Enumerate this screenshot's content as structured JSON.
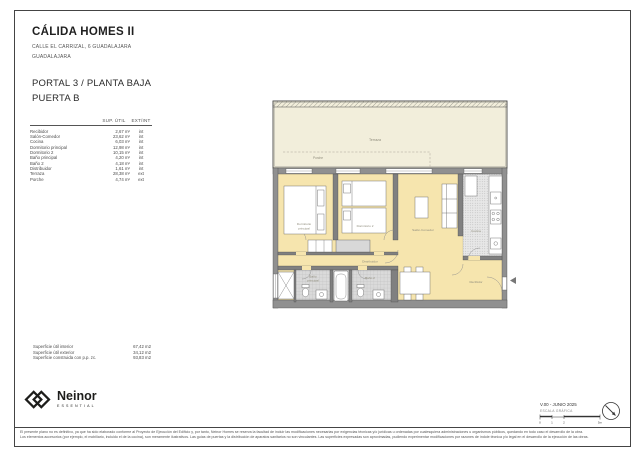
{
  "header": {
    "project": "CÁLIDA HOMES II",
    "address": "CALLE EL CARRIZAL, 6 GUADALAJARA",
    "city": "GUADALAJARA",
    "portal": "PORTAL 3 / PLANTA BAJA",
    "puerta": "PUERTA B"
  },
  "areas_table": {
    "headers": {
      "sup": "SUP. ÚTIL",
      "ext": "EXT/INT"
    },
    "rows": [
      {
        "label": "Recibidor",
        "sup": "2,67 m²",
        "ext": "int"
      },
      {
        "label": "Salón-Comedor",
        "sup": "23,62 m²",
        "ext": "int"
      },
      {
        "label": "Cocina",
        "sup": "6,03 m²",
        "ext": "int"
      },
      {
        "label": "Dormitorio principal",
        "sup": "12,98 m²",
        "ext": "int"
      },
      {
        "label": "Dormitorio 2",
        "sup": "10,15 m²",
        "ext": "int"
      },
      {
        "label": "Baño principal",
        "sup": "4,20 m²",
        "ext": "int"
      },
      {
        "label": "Baño 2",
        "sup": "4,18 m²",
        "ext": "int"
      },
      {
        "label": "Distribuidor",
        "sup": "1,61 m²",
        "ext": "int"
      },
      {
        "label": "Terraza",
        "sup": "28,38 m²",
        "ext": "ext"
      },
      {
        "label": "Porche",
        "sup": "4,74 m²",
        "ext": "ext"
      }
    ]
  },
  "summary": {
    "rows": [
      {
        "label": "Superficie útil interior",
        "value": "67,42 m2"
      },
      {
        "label": "Superficie útil exterior",
        "value": "34,12 m2"
      },
      {
        "label": "Superficie construida con p.p. zc.",
        "value": "93,83 m2"
      }
    ]
  },
  "plan": {
    "labels": {
      "terraza": "Terraza",
      "porche": "Porche",
      "dorm_principal_1": "Dormitorio",
      "dorm_principal_2": "principal",
      "dorm2": "Dormitorio 2",
      "salon": "Salón-Comedor",
      "cocina": "Cocina",
      "distribuidor": "Distribuidor",
      "bano_principal_1": "Baño",
      "bano_principal_2": "principal",
      "bano2": "Baño 2",
      "recibidor": "Recibidor"
    },
    "colors": {
      "room_floor": "#f6e5ae",
      "terrace_floor": "#f2eedb",
      "wall": "#909090"
    }
  },
  "footer": {
    "brand": "Neinor",
    "brand_sub": "ESSENTIAL",
    "version": "V.00 - JUNIO 2025",
    "scale_label": "ESCALA GRÁFICA",
    "scale_ticks": [
      "0",
      "1",
      "2",
      "5m"
    ],
    "disclaimer_line1": "El presente plano no es definitivo, ya que ha sido elaborado conforme al Proyecto de Ejecución del Edificio y, por tanto, Neinor Homes se reserva la facultad de incluir las modificaciones necesarias por exigencias técnicas y/o jurídicas u ordenadas por cualesquiera administraciones u organismos públicos, quedando en todo caso el desarrollo de la obra.",
    "disclaimer_line2": "Los elementos accesorios (por ejemplo, el mobiliario, incluido el de la cocina), son meramente ilustrativos. Las guías de puertas y la distribución de aparatos sanitarios no son vinculantes. Las superficies expresadas son aproximadas, pudiendo experimentar modificaciones por razones de índole técnica y/o legal en el desarrollo de la ejecución de las obras."
  }
}
